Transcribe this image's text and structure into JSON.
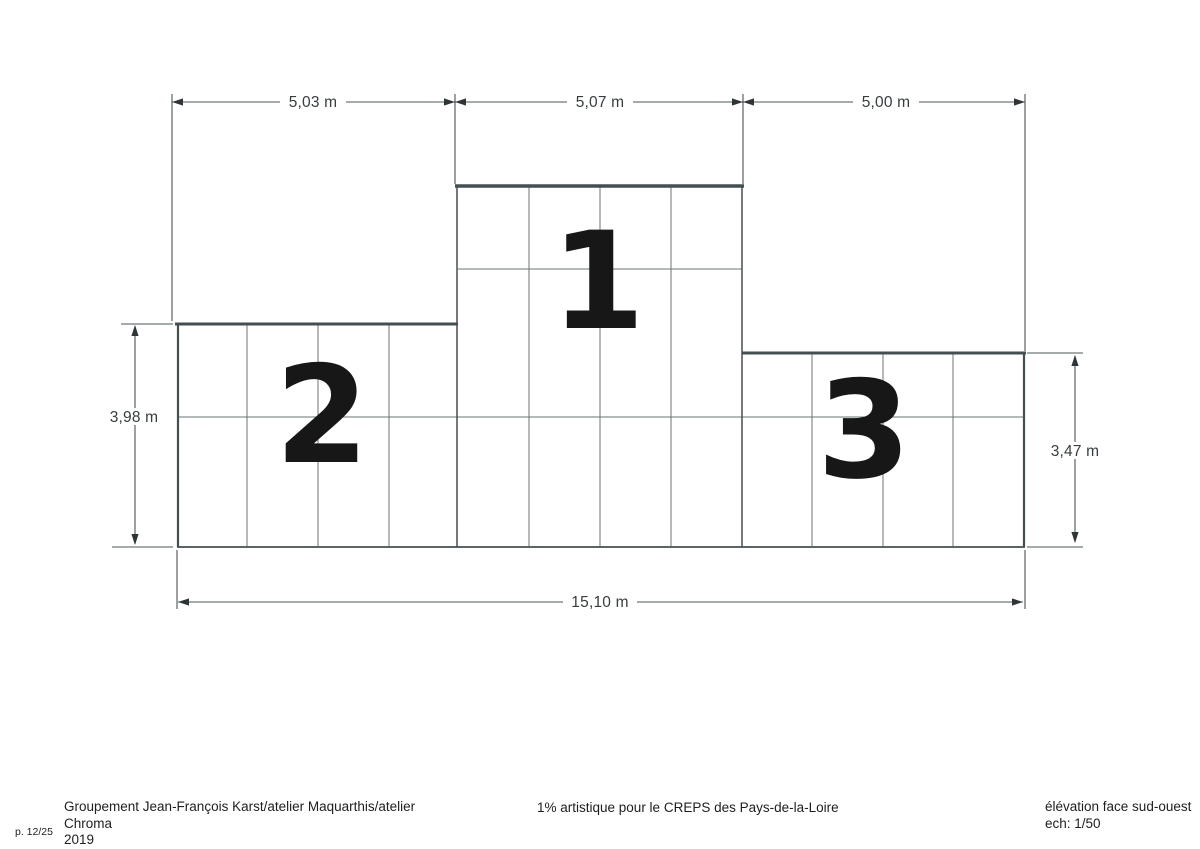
{
  "page": {
    "number": "p. 12/25"
  },
  "drawing": {
    "type": "architectural elevation of a three-step podium",
    "blocks": [
      {
        "id": "podium-second-place",
        "label": "2"
      },
      {
        "id": "podium-first-place",
        "label": "1"
      },
      {
        "id": "podium-third-place",
        "label": "3"
      }
    ],
    "dimensions": {
      "width_left": "5,03 m",
      "width_center": "5,07 m",
      "width_right": "5,00 m",
      "height_left": "3,98 m",
      "height_right": "3,47 m",
      "width_total": "15,10 m"
    },
    "colors": {
      "edge": "#454e51",
      "seam": "#6a7376",
      "dimension_line": "#4b5456",
      "dimension_text": "#363d3f",
      "digit": "#171717",
      "background": "#ffffff"
    }
  },
  "footer": {
    "credit_line1": "Groupement Jean-François Karst/atelier Maquarthis/atelier Chroma",
    "credit_line2": "2019",
    "project": "1% artistique pour le CREPS des Pays-de-la-Loire",
    "view_title": "élévation face sud-ouest",
    "scale": "ech: 1/50"
  }
}
